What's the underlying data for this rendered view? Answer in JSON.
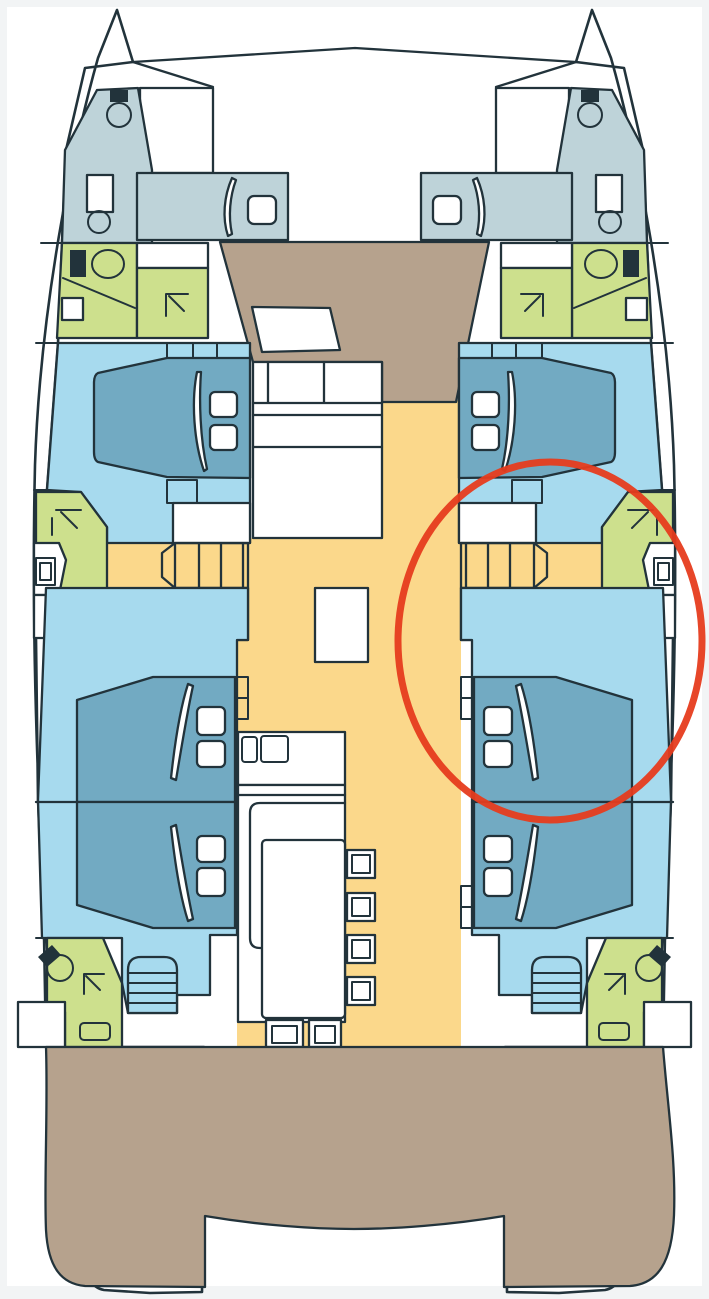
{
  "figure": {
    "title": "Catamaran yacht deck plan — 4 guest double cabins, 6 heads with showers, 2 bow crew berths, central salon with galley and dinette; red ellipse marks the starboard mid double cabin",
    "type": "catamaran-floor-plan"
  },
  "colors": {
    "page_margin": "#f2f4f5",
    "paper": "#ffffff",
    "outline": "#22333b",
    "berth_gray": "#bed3d9",
    "cabin_blue": "#a7daee",
    "bed_blue": "#72aac2",
    "head_green": "#cde08d",
    "floor_yellow": "#fbd88b",
    "deck_tan": "#b6a28d",
    "annotation_red": "#e63c1e"
  },
  "annotation": {
    "shape": "ellipse",
    "cx": 550,
    "cy": 641,
    "rx": 152,
    "ry": 179,
    "stroke_width": 7,
    "meaning": "highlight-circle over starboard mid cabin"
  },
  "legend": {
    "berth_gray": "bow crew berth / forepeak",
    "cabin_blue": "guest cabin floor",
    "bed_blue": "double bed",
    "head_green": "head / shower compartment",
    "floor_yellow": "salon & corridor floor",
    "deck_tan": "foredeck and aft deck",
    "paper": "hull, furniture, joinery"
  },
  "rooms": [
    {
      "name": "port-forepeak-crew-berth"
    },
    {
      "name": "starboard-forepeak-crew-berth"
    },
    {
      "name": "port-forward-head"
    },
    {
      "name": "starboard-forward-head"
    },
    {
      "name": "port-forward-guest-cabin"
    },
    {
      "name": "starboard-forward-guest-cabin"
    },
    {
      "name": "port-mid-head-shower"
    },
    {
      "name": "starboard-mid-head-shower"
    },
    {
      "name": "port-aft-guest-cabin"
    },
    {
      "name": "starboard-aft-guest-cabin"
    },
    {
      "name": "port-aft-head"
    },
    {
      "name": "starboard-aft-head"
    },
    {
      "name": "salon-galley-dinette"
    }
  ]
}
